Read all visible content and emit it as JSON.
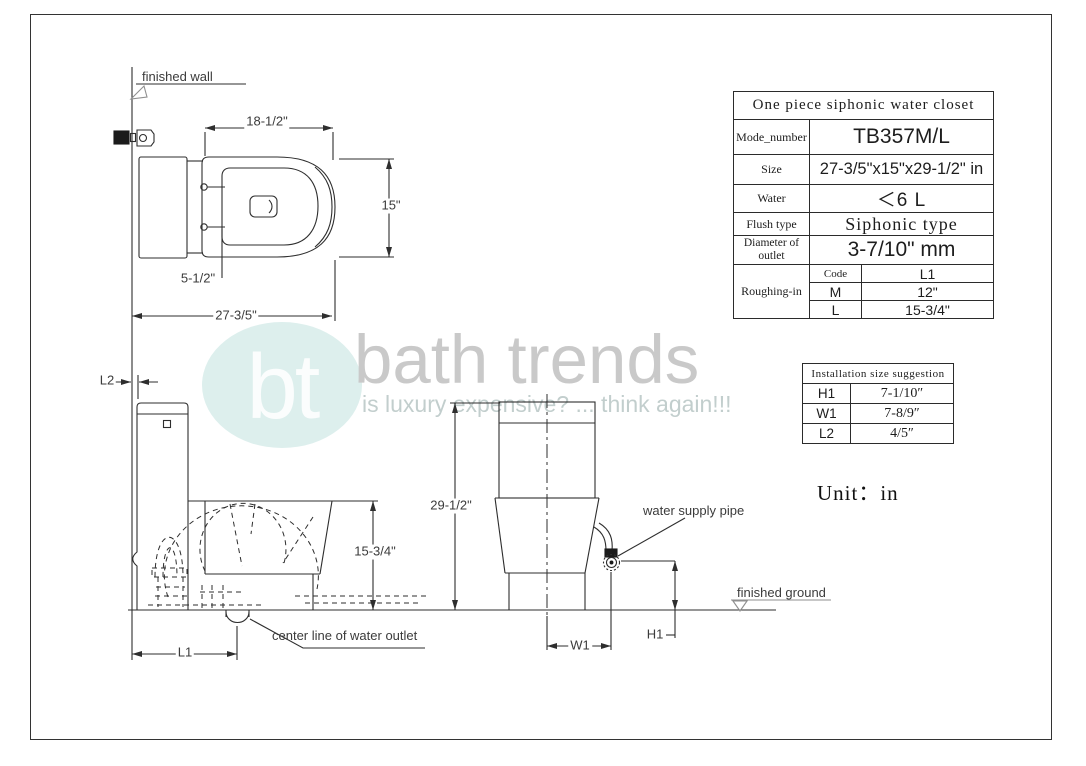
{
  "drawing": {
    "labels": {
      "finished_wall": "finished wall",
      "finished_ground": "finished ground",
      "water_supply_pipe": "water supply pipe",
      "center_line_of_water_outlet": "center line of water outlet"
    },
    "dimensions": {
      "seat_width": "18-1/2\"",
      "bowl_width": "15\"",
      "bolt_offset": "5-1/2\"",
      "total_length": "27-3/5\"",
      "l2": "L2",
      "total_height": "29-1/2\"",
      "rim_height": "15-3/4\"",
      "l1": "L1",
      "w1": "W1",
      "h1": "H1"
    }
  },
  "spec_table": {
    "title": "One piece siphonic water closet",
    "rows": [
      {
        "label": "Mode_number",
        "value": "TB357M/L"
      },
      {
        "label": "Size",
        "value": "27-3/5\"x15\"x29-1/2\" in"
      },
      {
        "label": "Water",
        "value": "＜6 L"
      },
      {
        "label": "Flush type",
        "value": "Siphonic type"
      },
      {
        "label": "Diameter of outlet",
        "value": "3-7/10\" mm"
      }
    ],
    "roughing_in": {
      "label": "Roughing-in",
      "header": {
        "code": "Code",
        "l1": "L1"
      },
      "rows": [
        {
          "code": "M",
          "l1": "12\""
        },
        {
          "code": "L",
          "l1": "15-3/4\""
        }
      ]
    }
  },
  "installation_table": {
    "title": "Installation size suggestion",
    "rows": [
      {
        "label": "H1",
        "value": "7-1/10″"
      },
      {
        "label": "W1",
        "value": "7-8/9″"
      },
      {
        "label": "L2",
        "value": "4/5″"
      }
    ]
  },
  "unit_label": "Unit：in",
  "watermark": {
    "logo": "bt",
    "brand": "bath trends",
    "tagline": "is luxury expensive? ... think again!!!"
  },
  "colors": {
    "line": "#2e2e2e",
    "watermark_circle": "#ddefed",
    "watermark_text": "#c9c9c9"
  }
}
